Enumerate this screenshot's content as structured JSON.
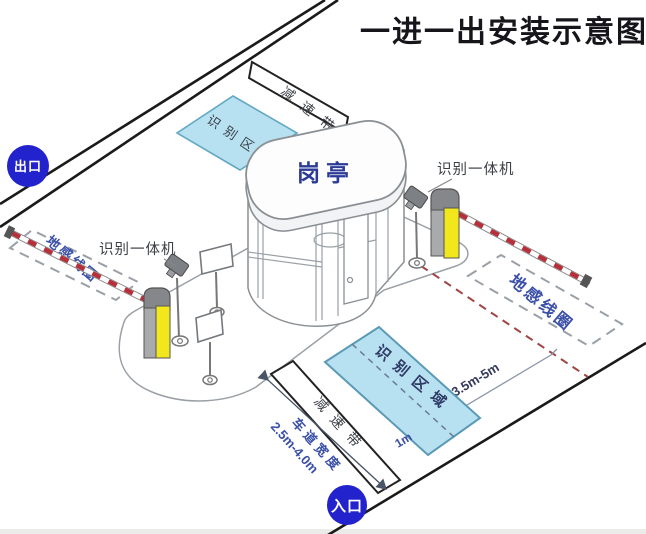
{
  "title": "一进一出安装示意图",
  "labels": {
    "exit": "出口",
    "entrance": "入口",
    "booth": "岗亭",
    "speed_bump": "减速带",
    "recognition_area": "识别区域",
    "ground_loop": "地感线圈",
    "recognition_machine": "识别一体机"
  },
  "dimensions": {
    "loop_distance": "3.5m-5m",
    "area_offset": "1m",
    "lane_width_label": "车道宽度",
    "lane_width_value": "2.5m-4.0m"
  },
  "colors": {
    "gate_circle_blue": "#2323cd",
    "area_fill_blue": "#b7e1f0",
    "area_stroke_blue": "#5b9ab5",
    "barrier_yellow": "#f2e71c",
    "barrier_arm_red": "#b5303a",
    "label_blue": "#3a4fa8",
    "booth_text_blue": "#2b3a96",
    "road_line": "#1a1a1a",
    "dashed_loop_gray": "#9aa0a6",
    "arm_projection_red": "#a04545"
  }
}
